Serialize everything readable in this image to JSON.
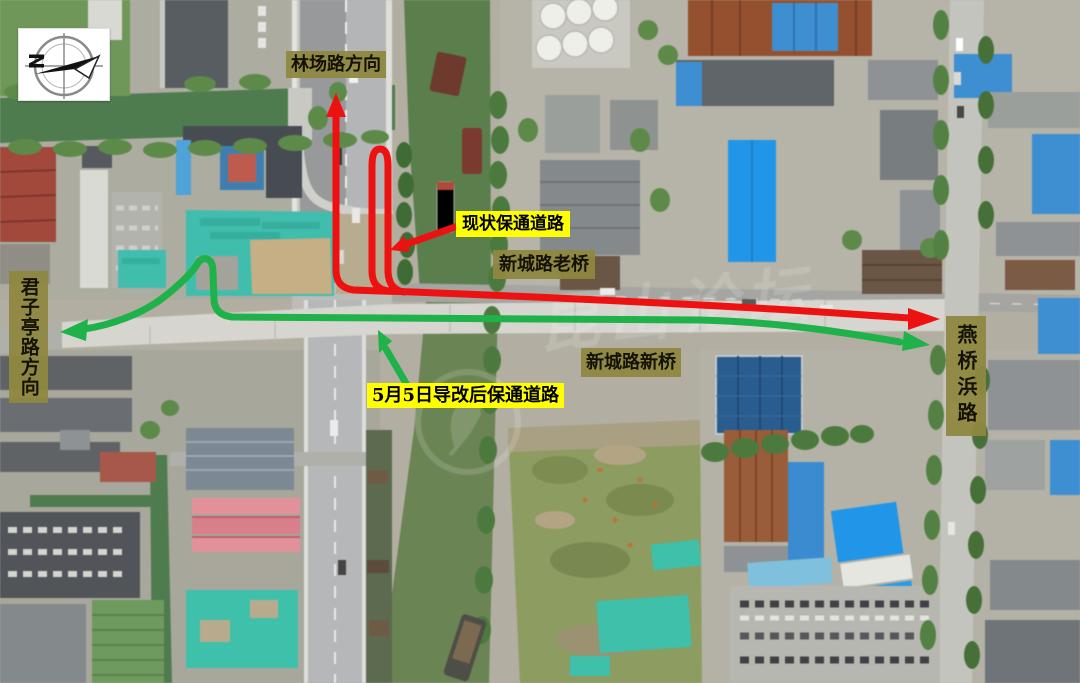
{
  "image": {
    "compass": {
      "letter": "N"
    },
    "watermark": {
      "text": "昆山论坛"
    },
    "labels": {
      "direction_north": "林场路方向",
      "current_detour": "现状保通道路",
      "old_bridge": "新城路老桥",
      "direction_west": "君子亭路方向",
      "new_bridge": "新城路新桥",
      "new_detour": "5月5日导改后保通道路",
      "direction_east": "燕桥浜路"
    },
    "colors": {
      "current_route": "#ee1111",
      "new_route": "#1fb14a",
      "callout_bg": "#ffff00",
      "roadname_bg": "#8f8740"
    }
  }
}
